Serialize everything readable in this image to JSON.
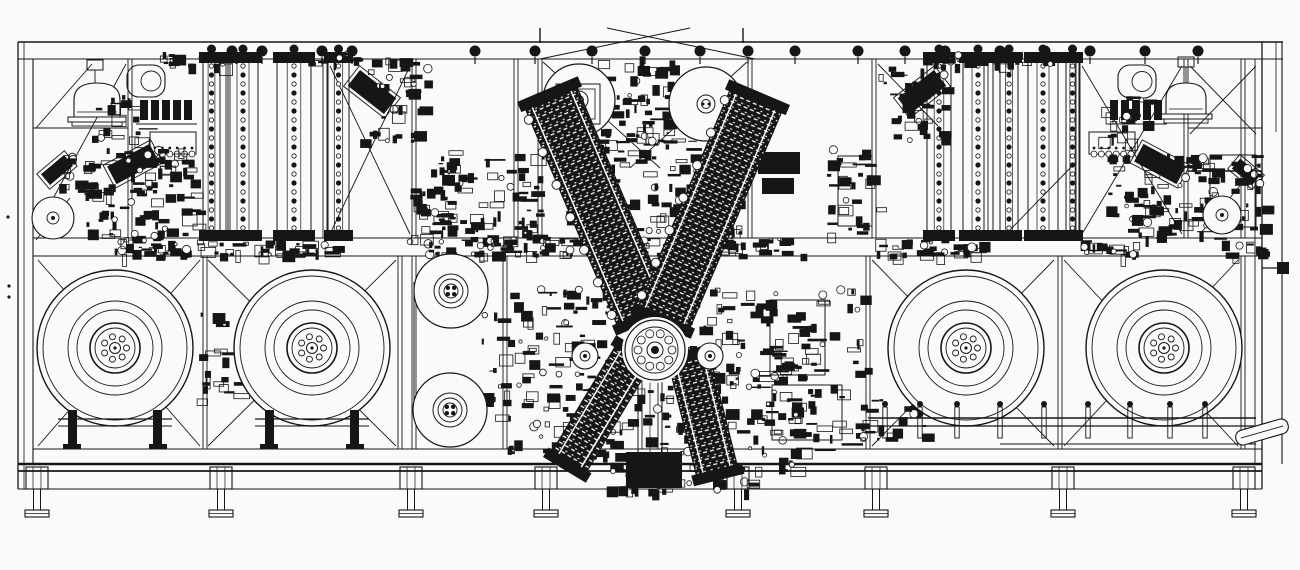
{
  "title": "Industrial machine line - CAD front elevation drawing",
  "canvas": {
    "width": 1300,
    "height": 570,
    "background": "#fafafa",
    "ink": "#161616"
  },
  "frame": {
    "hlines": [
      [
        18,
        42,
        1283,
        1.6
      ],
      [
        18,
        59,
        1283,
        1.1
      ],
      [
        33,
        238,
        1262,
        1.1
      ],
      [
        33,
        256,
        1262,
        1.1
      ],
      [
        33,
        449,
        1262,
        1.0
      ],
      [
        18,
        464,
        1262,
        2.6
      ],
      [
        18,
        471,
        1262,
        1.8
      ],
      [
        18,
        489,
        1262,
        1.1
      ],
      [
        33,
        128,
        128,
        0.9
      ],
      [
        1188,
        128,
        1262,
        0.9
      ],
      [
        1188,
        171,
        1262,
        1.4
      ],
      [
        1000,
        444,
        1256,
        0.9
      ]
    ],
    "vlines": [
      [
        18,
        42,
        489,
        1.3
      ],
      [
        24,
        42,
        489,
        0.8
      ],
      [
        33,
        59,
        464,
        1.1
      ],
      [
        1262,
        42,
        489,
        1.3
      ],
      [
        1255,
        59,
        464,
        0.9
      ],
      [
        1282,
        42,
        464,
        1.1
      ],
      [
        1276,
        42,
        132,
        0.8
      ]
    ],
    "posts_upper": [
      128,
      226,
      323,
      412,
      514,
      538,
      748,
      872,
      984,
      1076,
      1184,
      1241
    ],
    "posts_lower": [
      203,
      398,
      412,
      503,
      638,
      658,
      866,
      1058,
      1241
    ],
    "post_ticks": [
      [
        540,
        28,
        43
      ],
      [
        743,
        28,
        43
      ]
    ],
    "braces": [
      [
        36,
        230,
        126,
        64
      ],
      [
        36,
        128,
        92,
        64
      ],
      [
        330,
        66,
        410,
        234
      ],
      [
        410,
        66,
        330,
        234
      ],
      [
        543,
        62,
        660,
        168
      ],
      [
        747,
        62,
        630,
        168
      ],
      [
        878,
        64,
        938,
        126
      ],
      [
        1008,
        232,
        1076,
        162
      ],
      [
        1082,
        66,
        1182,
        234
      ],
      [
        1182,
        66,
        1082,
        234
      ],
      [
        1190,
        66,
        1256,
        134
      ],
      [
        1256,
        66,
        1190,
        134
      ],
      [
        1200,
        234,
        1258,
        164
      ],
      [
        38,
        260,
        200,
        446
      ],
      [
        200,
        260,
        38,
        446
      ],
      [
        208,
        260,
        396,
        446
      ],
      [
        396,
        260,
        208,
        446
      ],
      [
        872,
        260,
        1054,
        446
      ],
      [
        1054,
        260,
        872,
        446
      ],
      [
        1064,
        260,
        1238,
        446
      ],
      [
        1238,
        260,
        1064,
        446
      ],
      [
        36,
        240,
        70,
        198
      ]
    ],
    "gable": [
      [
        540,
        59,
        690,
        28
      ],
      [
        755,
        59,
        607,
        28
      ]
    ]
  },
  "reels_large": {
    "radii": [
      78,
      72,
      47,
      38,
      25,
      20
    ],
    "bolt_ring": 11.5,
    "bolt_r": 3,
    "bolts": 7,
    "center_r": 5.5,
    "centers": [
      [
        115,
        348
      ],
      [
        312,
        348
      ],
      [
        966,
        348
      ],
      [
        1164,
        348
      ]
    ]
  },
  "reels_top": [
    {
      "cx": 579,
      "cy": 100,
      "r": 36,
      "frame": [
        556,
        84,
        44,
        40
      ]
    },
    {
      "cx": 706,
      "cy": 104,
      "r": 37,
      "frame": null
    }
  ],
  "reels_column": [
    {
      "cx": 451,
      "cy": 291,
      "r": 37
    },
    {
      "cx": 450,
      "cy": 410,
      "r": 37
    }
  ],
  "column_belt": [
    414,
    282,
    414,
    420
  ],
  "small_wheels": [
    [
      53,
      218,
      21,
      6
    ],
    [
      1222,
      215,
      19,
      6
    ],
    [
      585,
      356,
      13,
      5
    ],
    [
      710,
      356,
      13,
      5
    ]
  ],
  "ladders": {
    "y1": 58,
    "y2": 236,
    "left": [
      [
        203,
        17
      ],
      [
        228,
        30
      ],
      [
        277,
        34
      ],
      [
        328,
        21
      ]
    ],
    "right": [
      [
        927,
        24
      ],
      [
        963,
        30
      ],
      [
        1000,
        18
      ],
      [
        1028,
        30
      ],
      [
        1066,
        13
      ]
    ]
  },
  "domes": [
    {
      "bx": 74,
      "baseY": 117,
      "w": 46,
      "h": 34,
      "cap": [
        87,
        60,
        16,
        10
      ]
    },
    {
      "bx": 1166,
      "baseY": 114,
      "w": 40,
      "h": 31,
      "cap": [
        1178,
        57,
        16,
        10
      ]
    }
  ],
  "pots": [
    [
      127,
      65,
      38,
      32
    ],
    [
      1118,
      65,
      38,
      33
    ]
  ],
  "combs": [
    [
      150,
      132,
      46,
      22
    ],
    [
      1089,
      132,
      46,
      22
    ]
  ],
  "valve_banks": [
    {
      "x0": 140,
      "y": 100,
      "n": 5
    },
    {
      "x0": 1110,
      "y": 100,
      "n": 5
    }
  ],
  "angled_units": [
    [
      372,
      92,
      46,
      20,
      38
    ],
    [
      922,
      92,
      46,
      20,
      -38
    ],
    [
      133,
      164,
      48,
      20,
      -28
    ],
    [
      1160,
      164,
      48,
      20,
      28
    ],
    [
      57,
      170,
      30,
      14,
      -40
    ],
    [
      1246,
      172,
      26,
      13,
      40
    ]
  ],
  "v_arms": [
    {
      "cx": 597,
      "cy": 206,
      "w": 56,
      "h": 240,
      "rot": -23,
      "rollers": 7
    },
    {
      "cx": 710,
      "cy": 209,
      "w": 56,
      "h": 240,
      "rot": 23,
      "rollers": 7
    },
    {
      "cx": 601,
      "cy": 409,
      "w": 40,
      "h": 128,
      "rot": 31,
      "rollers": 0
    },
    {
      "cx": 703,
      "cy": 415,
      "w": 42,
      "h": 120,
      "rot": -14,
      "rollers": 0
    }
  ],
  "turret": {
    "cx": 655,
    "cy": 350,
    "r_outer": 30,
    "r_inner": 23,
    "gear_n": 10,
    "gear_R": 17,
    "gear_r": 4
  },
  "pedestal": [
    638,
    300,
    24,
    164
  ],
  "conveyor": {
    "y1": 418,
    "y2": 426,
    "x1": 868,
    "x2": 1256,
    "ticks": [
      885,
      920,
      957,
      1000,
      1044,
      1088,
      1130,
      1170,
      1205
    ],
    "chute": {
      "cx": 1262,
      "cy": 432,
      "w": 54,
      "h": 15,
      "rot": -16
    }
  },
  "stands": [
    115,
    312
  ],
  "feet": [
    37,
    221,
    411,
    546,
    738,
    876,
    1063,
    1244
  ],
  "pulleys": {
    "y": 51,
    "xs": [
      232,
      262,
      322,
      352,
      475,
      535,
      592,
      645,
      700,
      748,
      795,
      858,
      905,
      945,
      1000,
      1045,
      1090,
      1145,
      1198
    ]
  },
  "panels": [
    [
      770,
      300,
      55,
      75
    ],
    [
      772,
      385,
      70,
      55
    ],
    [
      838,
      156,
      34,
      70
    ],
    [
      1210,
      155,
      46,
      72
    ]
  ],
  "blocks": [
    [
      758,
      152,
      42,
      22
    ],
    [
      762,
      178,
      32,
      16
    ],
    [
      626,
      452,
      56,
      36
    ]
  ],
  "pins": {
    "right_line": [
      1262,
      268,
      1284,
      268
    ],
    "right_box": [
      1277,
      262,
      12,
      12
    ],
    "left_dots": [
      [
        8,
        217
      ],
      [
        9,
        286
      ],
      [
        9,
        297
      ]
    ]
  },
  "clutter": [
    [
      84,
      148,
      112,
      90,
      95,
      11
    ],
    [
      92,
      94,
      50,
      44,
      22,
      12
    ],
    [
      356,
      58,
      72,
      84,
      40,
      13
    ],
    [
      430,
      148,
      118,
      92,
      85,
      14
    ],
    [
      478,
      288,
      72,
      164,
      55,
      15
    ],
    [
      548,
      288,
      264,
      184,
      300,
      16
    ],
    [
      596,
      56,
      74,
      86,
      55,
      17
    ],
    [
      564,
      128,
      176,
      114,
      150,
      18
    ],
    [
      826,
      148,
      56,
      88,
      35,
      19
    ],
    [
      1104,
      148,
      114,
      90,
      95,
      20
    ],
    [
      1098,
      94,
      52,
      46,
      22,
      21
    ],
    [
      878,
      58,
      66,
      84,
      38,
      22
    ],
    [
      112,
      239,
      122,
      16,
      40,
      23
    ],
    [
      232,
      240,
      102,
      15,
      30,
      24
    ],
    [
      424,
      239,
      122,
      16,
      40,
      25
    ],
    [
      554,
      237,
      112,
      17,
      36,
      26
    ],
    [
      686,
      237,
      118,
      17,
      36,
      27
    ],
    [
      870,
      239,
      112,
      16,
      36,
      28
    ],
    [
      1078,
      240,
      58,
      15,
      18,
      29
    ],
    [
      1220,
      240,
      46,
      15,
      14,
      30
    ],
    [
      762,
      288,
      104,
      164,
      60,
      31
    ],
    [
      860,
      398,
      64,
      44,
      22,
      32
    ],
    [
      1206,
      148,
      58,
      84,
      30,
      33
    ],
    [
      536,
      92,
      50,
      46,
      22,
      34
    ],
    [
      718,
      92,
      50,
      46,
      22,
      35
    ],
    [
      160,
      52,
      80,
      12,
      18,
      36
    ],
    [
      940,
      52,
      120,
      12,
      22,
      37
    ],
    [
      56,
      150,
      36,
      40,
      18,
      38
    ],
    [
      410,
      186,
      40,
      56,
      24,
      39
    ],
    [
      300,
      52,
      60,
      12,
      12,
      40
    ],
    [
      604,
      468,
      150,
      22,
      28,
      41
    ],
    [
      196,
      310,
      40,
      90,
      20,
      42
    ]
  ]
}
